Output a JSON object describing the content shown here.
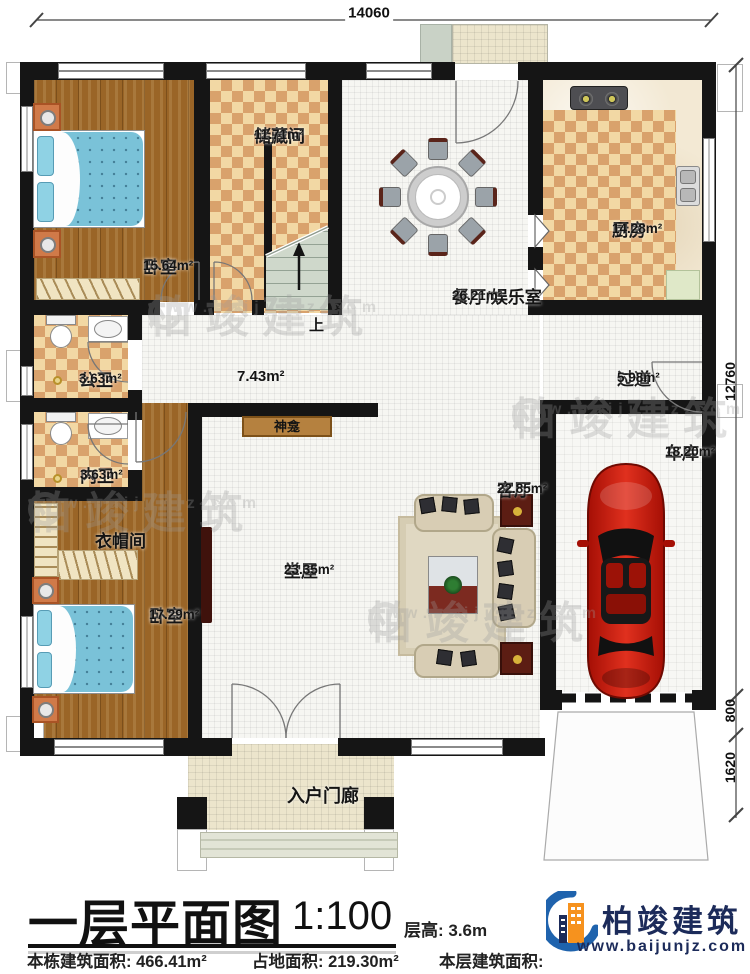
{
  "dims": {
    "top": "14060",
    "right_main": "12760",
    "right_mid": "800",
    "right_low": "1620"
  },
  "rooms": {
    "bedroom1": {
      "name": "卧室",
      "area": "15.64m²"
    },
    "storage": {
      "name": "储藏间",
      "area": "11.71m²"
    },
    "dining": {
      "name": "餐厅/娱乐室",
      "area": "26.21m²"
    },
    "kitchen": {
      "name": "厨房",
      "area": "14.28m²"
    },
    "public_bath": {
      "name": "公卫",
      "area": "3.63m²"
    },
    "inner_bath": {
      "name": "内卫",
      "area": "3.63m²"
    },
    "cloakroom": {
      "name": "衣帽间"
    },
    "bedroom2": {
      "name": "卧室",
      "area": "17.29m²"
    },
    "hall": {
      "name": "堂屋",
      "area": "23.35m²"
    },
    "living": {
      "name": "客厅",
      "area": "22.85m²"
    },
    "garage": {
      "name": "车库",
      "area": "18.20m²"
    },
    "passage": {
      "name": "过道",
      "area": "5.98m²"
    },
    "corridor": {
      "area": "7.43m²"
    },
    "porch": {
      "name": "入户门廊"
    },
    "shrine": {
      "name": "神龛"
    },
    "stairs_up": {
      "name": "上"
    }
  },
  "title_block": {
    "title": "一层平面图",
    "scale": "1:100",
    "floor_height": "层高: 3.6m",
    "total_area": "本栋建筑面积: 466.41m²",
    "land_area": "占地面积: 219.30m²",
    "floor_area": "本层建筑面积: 198.25m²"
  },
  "logo": {
    "name": "柏竣建筑",
    "url": "www.baijunjz.com"
  },
  "watermark": {
    "brand": "柏竣建筑",
    "url": "www.baijunjz.com"
  },
  "colors": {
    "wall": "#151515",
    "wood": "#9a6527",
    "checker_dark": "#d9a26c",
    "checker_light": "#f2d8a4",
    "tile": "#f6f6f2",
    "porch": "#ece5cc",
    "bed": "#7ac2d8",
    "stairs": "#cfd8cb",
    "car_red": "#c2170a",
    "sofa": "#d8cdb4",
    "dark_red_furniture": "#5c1d13",
    "shrine": "#b5813f",
    "logo_navy": "#1c2b5a",
    "logo_blue": "#1f63ad",
    "logo_orange": "#f6921e",
    "watermark_gray": "#9b9b9b"
  }
}
